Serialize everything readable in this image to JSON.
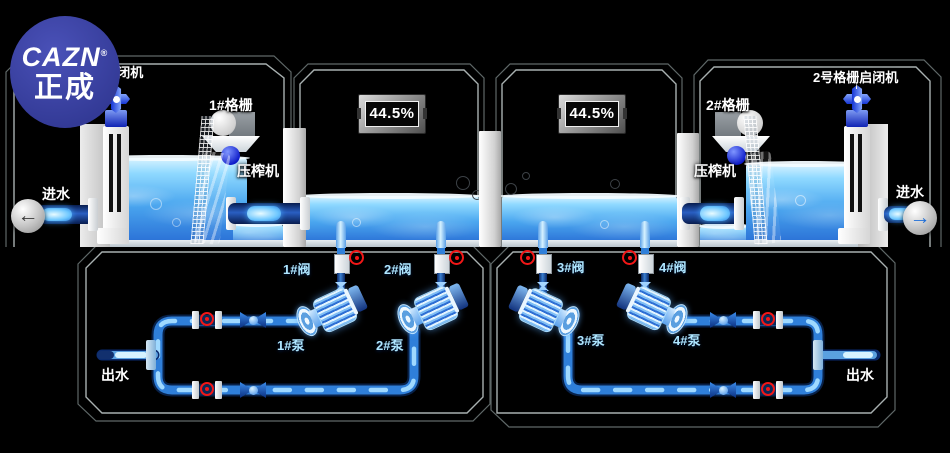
{
  "logo": {
    "brand": "CAZN",
    "reg": "®",
    "name": "正成"
  },
  "tanks": {
    "hoist_left_label": "1号格栅启闭机",
    "hoist_right_label": "2号格栅启闭机",
    "screen_left_label": "1#格栅",
    "screen_right_label": "2#格栅",
    "press_left_label": "压榨机",
    "press_right_label": "压榨机",
    "inlet_left_label": "进水",
    "inlet_right_label": "进水",
    "level_display_1": "44.5%",
    "level_display_2": "44.5%",
    "inlet_left_arrow": "←",
    "inlet_right_arrow": "→"
  },
  "pumping": {
    "valve_labels": [
      "1#阀",
      "2#阀",
      "3#阀",
      "4#阀"
    ],
    "pump_labels": [
      "1#泵",
      "2#泵",
      "3#泵",
      "4#泵"
    ],
    "outlet_left_label": "出水",
    "outlet_right_label": "出水"
  },
  "colors": {
    "background": "#000000",
    "panel_border_inner": "#a8b0b0",
    "panel_border_outer": "#5f6868",
    "water_top": "#d9f3ff",
    "water_deep": "#2a70d6",
    "pipe_core": "#2f7fd9",
    "pipe_glow": "#9fd9ff",
    "pipe_dark": "#0a2a5e",
    "label_cyan": "#aee6ff",
    "label_white": "#ffffff",
    "indicator_red": "#f21717",
    "logo_blue": "#3c42a0",
    "bezel_gray": "#9a9a9a"
  }
}
